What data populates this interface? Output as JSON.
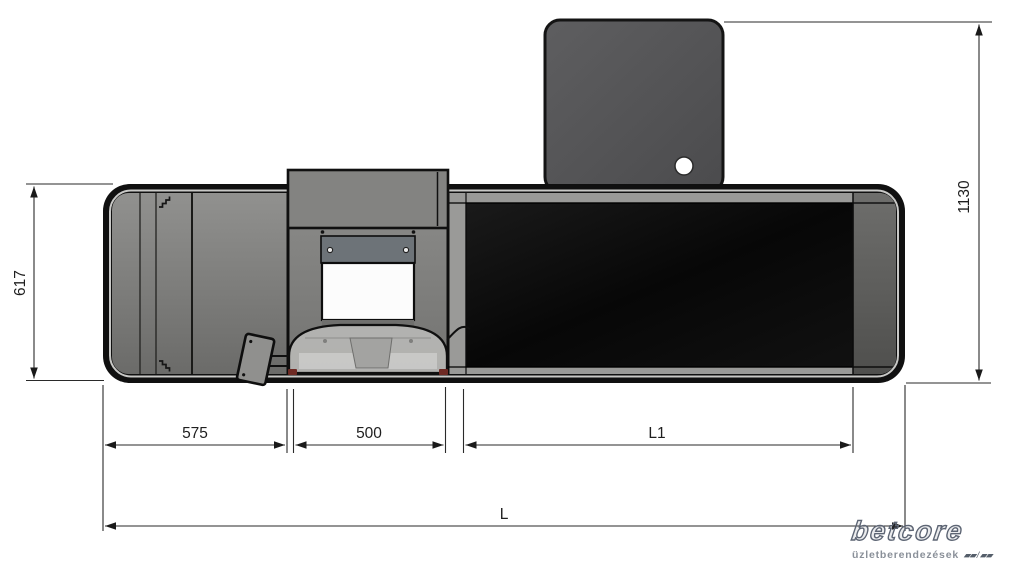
{
  "drawing": {
    "type": "technical-top-view",
    "dimensions": {
      "body_depth": "617",
      "total_depth": "1130",
      "left_section_width": "575",
      "printer_section_width": "500",
      "screen_section_width": "L1",
      "total_length": "L"
    },
    "logo": {
      "brand": "betcore",
      "tagline": "üzletberendezések",
      "marks": "▰▰ / ▰▰"
    },
    "colors": {
      "background": "#ffffff",
      "outline": "#1a1a1a",
      "body_border": "#101010",
      "body_gray": "#7c7c7a",
      "rear_panel_gray": "#545456",
      "screen_black": "#0a0a0a",
      "dome_gray": "#b4b4b2",
      "plate_gray": "#6d7378",
      "logo_blue_gray": "#5d6574"
    }
  }
}
